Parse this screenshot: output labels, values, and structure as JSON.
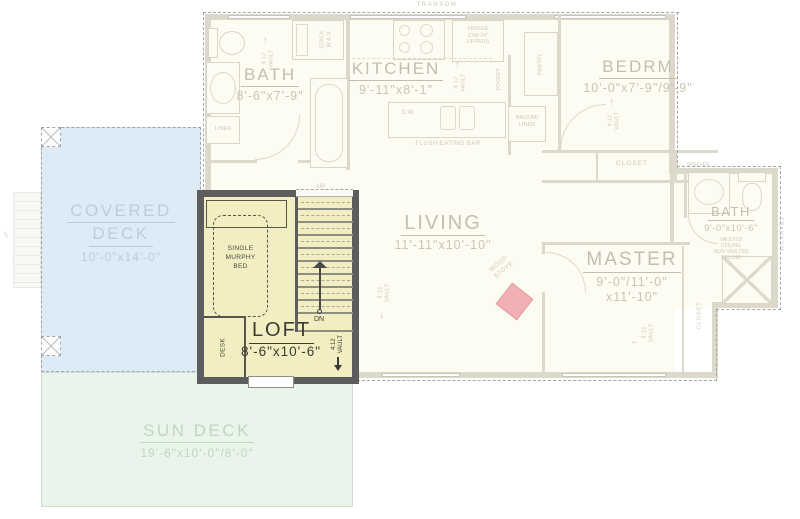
{
  "meta": {
    "drawing": "loft level floor plan"
  },
  "colors": {
    "loft_fill": "#f2eec2",
    "loft_wall": "#5d5d5e",
    "covered_deck": "#dcebf6",
    "sun_deck": "#e9f4ea",
    "wood_stove": "#f1b1b4",
    "faded_ink": "#c8c5b3",
    "dark_ink": "#3c3b34",
    "roof_dash": "#a6a6a6"
  },
  "icons": {
    "arrow_up": "↑",
    "arrow_down": "↓",
    "arrow_left": "←"
  },
  "plan": {
    "transom_top": "TRANSOM",
    "transom_right": "TRANSOM",
    "rooms": {
      "bath_main": {
        "name": "BATH",
        "dims": "8'-6\"x7'-9\""
      },
      "kitchen": {
        "name": "KITCHEN",
        "dims": "9'-11\"x8'-1\""
      },
      "bedroom": {
        "name": "BEDRM",
        "dims": "10'-0\"x7'-9\"/9'-9\""
      },
      "living": {
        "name": "LIVING",
        "dims": "11'-11\"x10'-10\""
      },
      "master": {
        "name": "MASTER",
        "dims_line1": "9'-0\"/11'-0\"",
        "dims_line2": "x11'-10\""
      },
      "bath_master": {
        "name": "BATH",
        "dims": "9'-0\"x10'-6\"",
        "ceiling_note": "VAULTED\nCEILING\nNON-VAULTED\nCEILING"
      }
    },
    "labels": {
      "stack_wd": "STACK\nW & D",
      "fridge": "FRIDGE\nC/W 24\"\nUPPERS",
      "pantry": "PANTRY",
      "pocket": "POCKET",
      "broom_linen": "BROOM/\nLINEN",
      "linen": "LINEN",
      "dw": "D.W.",
      "flush_eating_bar": "FLUSH EATING BAR",
      "closet": "CLOSET",
      "shelves": "SHELVES",
      "wood_stove": "WOOD\nSTOVE",
      "vault": "4:12\nVAULT",
      "up": "UP",
      "dn": "DN"
    }
  },
  "loft": {
    "name": "LOFT",
    "dims": "8'-6\"x10'-6\"",
    "murphy_bed": "SINGLE\nMURPHY\nBED",
    "desk": "DESK"
  },
  "decks": {
    "covered": {
      "name_line1": "COVERED",
      "name_line2": "DECK",
      "dims": "10'-0\"x14'-0\""
    },
    "sun": {
      "name": "SUN DECK",
      "dims": "19'-6\"x10'-0\"/8'-0\""
    }
  }
}
